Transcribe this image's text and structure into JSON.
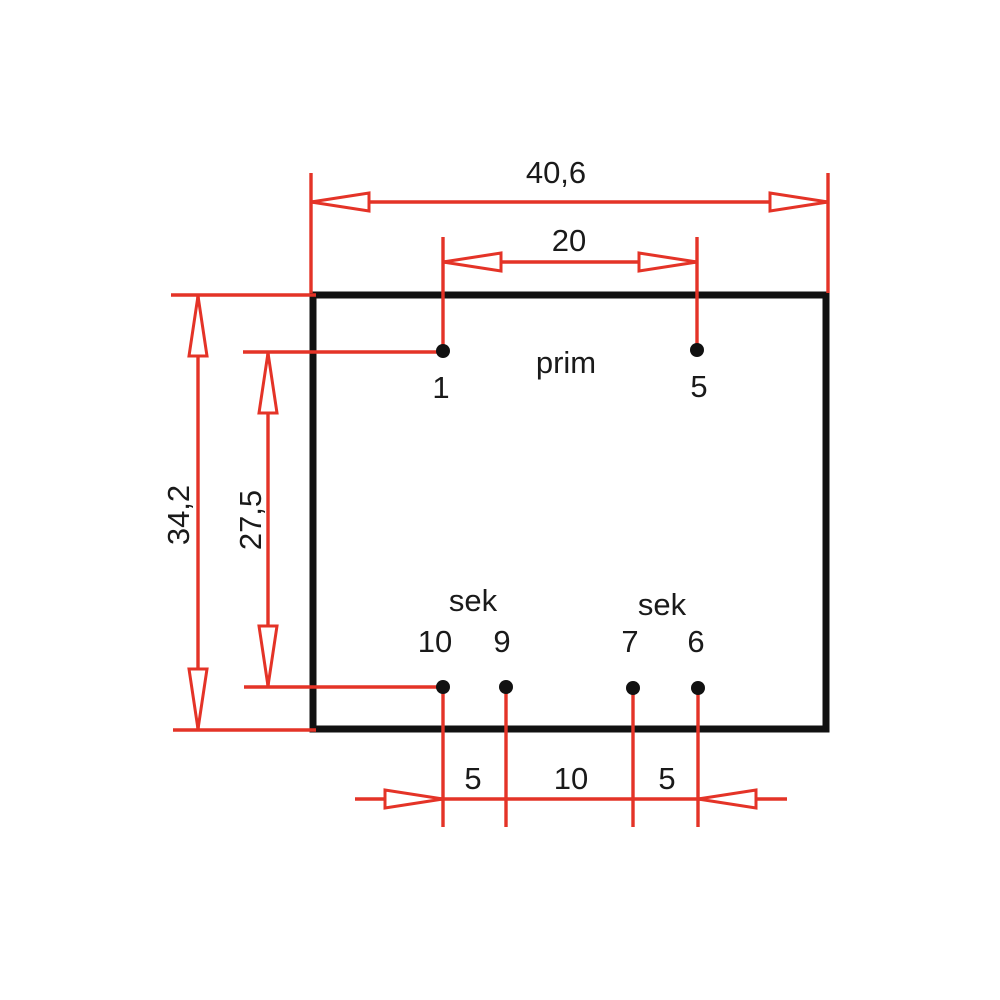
{
  "drawing": {
    "kind": "transformer-footprint-dimension-drawing",
    "colors": {
      "dimension_red": "#e43327",
      "outline_black": "#111111",
      "text_black": "#1a1a1a",
      "background": "#ffffff"
    },
    "winding_labels": {
      "primary": "prim",
      "secondary_left": "sek",
      "secondary_right": "sek"
    },
    "pins": {
      "top": [
        {
          "number": "1"
        },
        {
          "number": "5"
        }
      ],
      "bottom": [
        {
          "number": "10"
        },
        {
          "number": "9"
        },
        {
          "number": "7"
        },
        {
          "number": "6"
        }
      ]
    },
    "dimensions": {
      "overall_width": "40,6",
      "primary_pin_spacing": "20",
      "overall_height": "34,2",
      "pin_row_spacing": "27,5",
      "secondary_spacing_left": "5",
      "secondary_spacing_middle": "10",
      "secondary_spacing_right": "5"
    }
  }
}
